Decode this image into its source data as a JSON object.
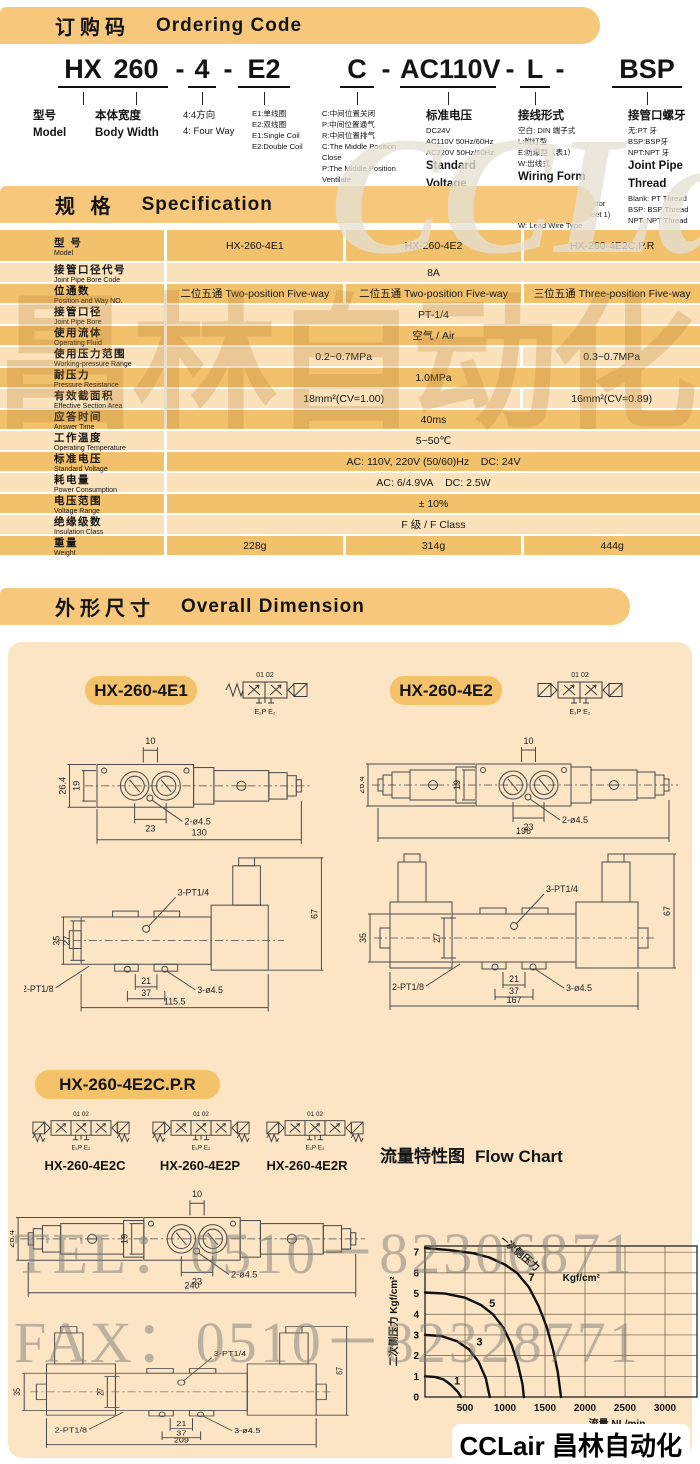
{
  "colors": {
    "banner": "#f7c87c",
    "row_dark": "#f2c16c",
    "row_light": "#fbe2bb",
    "panel": "#fbe5c4",
    "pill": "#f4c369",
    "ink": "#141414"
  },
  "ordering": {
    "banner_zh": "订购码",
    "banner_en": "Ordering Code",
    "code_parts": [
      "HX",
      "260",
      "-",
      "4",
      "-",
      "E2",
      "C",
      "-",
      "AC110V",
      "-",
      "L",
      "-",
      "BSP"
    ],
    "columns": [
      {
        "lines": [
          {
            "t": "型号",
            "b": 1
          },
          {
            "t": "Model",
            "b": 1
          }
        ]
      },
      {
        "lines": [
          {
            "t": "本体宽度",
            "b": 1
          },
          {
            "t": "Body Width",
            "b": 1
          }
        ]
      },
      {
        "lines": [
          {
            "t": "4:4方向"
          },
          {
            "t": "4: Four Way"
          }
        ]
      },
      {
        "lines": [
          {
            "t": "E1:单线圈"
          },
          {
            "t": "E2:双线圈"
          },
          {
            "t": "E1:Single Coil"
          },
          {
            "t": "E2:Double Coil"
          }
        ]
      },
      {
        "lines": [
          {
            "t": "C:中间位置关闭"
          },
          {
            "t": "P:中间位置通气"
          },
          {
            "t": "R:中间位置排气"
          },
          {
            "t": "C:The Middle Position"
          },
          {
            "t": "Close"
          },
          {
            "t": "P:The Middle Position"
          },
          {
            "t": "Ventilate"
          },
          {
            "t": "R:The Middle Position"
          },
          {
            "t": "Exhaust"
          }
        ]
      },
      {
        "lines": [
          {
            "t": "标准电压",
            "b": 1
          },
          {
            "t": "DC24V"
          },
          {
            "t": "AC110V 50Hz/60Hz"
          },
          {
            "t": "AC220V 50Hz/60Hz"
          },
          {
            "t": "Standard",
            "b": 1
          },
          {
            "t": "Voltage",
            "b": 1
          },
          {
            "t": "DC24V"
          },
          {
            "t": "AC110V 50Hz/60Hz"
          },
          {
            "t": "AC220V 50Hz/60Hz"
          }
        ]
      },
      {
        "lines": [
          {
            "t": "接线形式",
            "b": 1
          },
          {
            "t": "空白: DIN 端子式"
          },
          {
            "t": "L:附灯型"
          },
          {
            "t": "E:防爆型（表1）"
          },
          {
            "t": "W:出线式"
          },
          {
            "t": "Wiring Form",
            "b": 1
          },
          {
            "t": "Blank:DIN Connector"
          },
          {
            "t": "L:With Lighting Connector"
          },
          {
            "t": "E:Blast-proof Type(sheet 1)"
          },
          {
            "t": "W: Lead Wire Type"
          }
        ]
      },
      {
        "lines": [
          {
            "t": "接管口螺牙",
            "b": 1
          },
          {
            "t": "无:PT 牙"
          },
          {
            "t": "BSP:BSP牙"
          },
          {
            "t": "NPT:NPT 牙"
          },
          {
            "t": "Joint Pipe",
            "b": 1
          },
          {
            "t": "Thread",
            "b": 1
          },
          {
            "t": "Blank: PT Thread"
          },
          {
            "t": "BSP: BSP Thread"
          },
          {
            "t": "NPT: NPT Thread"
          }
        ]
      }
    ]
  },
  "spec": {
    "banner_zh": "规 格",
    "banner_en": "Specification",
    "rows": [
      {
        "zh": "型 号",
        "en": "Model",
        "cells": [
          {
            "t": "HX-260-4E1",
            "s": 1
          },
          {
            "t": "HX-260-4E2",
            "s": 1
          },
          {
            "t": "HX-260-4E2C.P.R",
            "s": 1
          }
        ]
      },
      {
        "zh": "接管口径代号",
        "en": "Joint Pipe Bore Code",
        "cells": [
          {
            "t": "8A",
            "s": 3
          }
        ]
      },
      {
        "zh": "位通数",
        "en": "Position and Way NO.",
        "cells": [
          {
            "t": "二位五通  Two-position Five-way",
            "s": 1
          },
          {
            "t": "二位五通  Two-position Five-way",
            "s": 1
          },
          {
            "t": "三位五通  Three-position Five-way",
            "s": 1
          }
        ]
      },
      {
        "zh": "接管口径",
        "en": "Joint Pipe Bore",
        "cells": [
          {
            "t": "PT-1/4",
            "s": 3
          }
        ]
      },
      {
        "zh": "使用流体",
        "en": "Operating Fluid",
        "cells": [
          {
            "t": "空气  /  Air",
            "s": 3
          }
        ]
      },
      {
        "zh": "使用压力范围",
        "en": "Working-pressure Range",
        "cells": [
          {
            "t": "0.2~0.7MPa",
            "s": 2
          },
          {
            "t": "0.3~0.7MPa",
            "s": 1
          }
        ]
      },
      {
        "zh": "耐压力",
        "en": "Pressure Resistance",
        "cells": [
          {
            "t": "1.0MPa",
            "s": 3
          }
        ]
      },
      {
        "zh": "有效截面积",
        "en": "Effective  Section  Area",
        "cells": [
          {
            "t": "18mm²(CV=1.00)",
            "s": 2
          },
          {
            "t": "16mm²(CV=0.89)",
            "s": 1
          }
        ]
      },
      {
        "zh": "应答时间",
        "en": "Answer Time",
        "cells": [
          {
            "t": "40ms",
            "s": 3
          }
        ]
      },
      {
        "zh": "工作温度",
        "en": "Operating Temperature",
        "cells": [
          {
            "t": "5~50℃",
            "s": 3
          }
        ]
      },
      {
        "zh": "标准电压",
        "en": "Standard Voltage",
        "cells": [
          {
            "t": "AC: 110V, 220V (50/60)Hz    DC: 24V",
            "s": 3
          }
        ]
      },
      {
        "zh": "耗电量",
        "en": "Power Consumption",
        "cells": [
          {
            "t": "AC: 6/4.9VA    DC: 2.5W",
            "s": 3
          }
        ]
      },
      {
        "zh": "电压范围",
        "en": "Voltage Range",
        "cells": [
          {
            "t": "± 10%",
            "s": 3
          }
        ]
      },
      {
        "zh": "绝缘级数",
        "en": "Insulation Class",
        "cells": [
          {
            "t": "F 级  /  F Class",
            "s": 3
          }
        ]
      },
      {
        "zh": "重量",
        "en": "Weight",
        "cells": [
          {
            "t": "228g",
            "s": 1
          },
          {
            "t": "314g",
            "s": 1
          },
          {
            "t": "444g",
            "s": 1
          }
        ]
      }
    ]
  },
  "dimension_section": {
    "banner_zh": "外形尺寸",
    "banner_en": "Overall Dimension",
    "pills": [
      "HX-260-4E1",
      "HX-260-4E2",
      "HX-260-4E2C.P.R"
    ],
    "sub_models": [
      "HX-260-4E2C",
      "HX-260-4E2P",
      "HX-260-4E2R"
    ]
  },
  "symbols": {
    "top": "01 02",
    "bottom": "E₁P E₂"
  },
  "dims": {
    "e1_top": {
      "s10": "10",
      "s264": "26.4",
      "s19": "19",
      "s23": "23",
      "holes": "2-ø4.5",
      "total": "130"
    },
    "e2_top": {
      "s10": "10",
      "s264": "26.4",
      "s19": "19",
      "s23": "23",
      "holes": "2-ø4.5",
      "total": "196"
    },
    "cpr_top": {
      "s10": "10",
      "s264": "26.4",
      "s19": "19",
      "s23": "23",
      "holes": "2-ø4.5",
      "total": "240"
    },
    "e1_side": {
      "pt": "3-PT1/4",
      "s35": "35",
      "s27": "27",
      "s67": "67",
      "pt2": "2-PT1/8",
      "s21": "21",
      "s37": "37",
      "holes": "3-ø4.5",
      "total": "115.5"
    },
    "e2_side": {
      "pt": "3-PT1/4",
      "s35": "35",
      "s27": "27",
      "s67": "67",
      "pt2": "2-PT1/8",
      "s21": "21",
      "s37": "37",
      "holes": "3-ø4.5",
      "total": "167"
    },
    "cpr_side": {
      "pt": "3-PT1/4",
      "s35": "35",
      "s27": "27",
      "s67": "67",
      "pt2": "2-PT1/8",
      "s21": "21",
      "s37": "37",
      "holes": "3-ø4.5",
      "total": "209"
    }
  },
  "chart_data": {
    "type": "line",
    "title_zh": "流量特性图",
    "title_en": "Flow Chart",
    "xlabel": "流量   NL/min",
    "ylabel": "二次侧压力   Kgf/cm²",
    "annotation": "一次侧压力",
    "annotation_unit": "Kgf/cm²",
    "xlim": [
      0,
      3400
    ],
    "ylim": [
      0,
      7.3
    ],
    "xticks": [
      500,
      1000,
      1500,
      2000,
      2500,
      3000
    ],
    "yticks": [
      0,
      1,
      2,
      3,
      4,
      5,
      6,
      7
    ],
    "grid": true,
    "legend": "inline curve labels",
    "series": [
      {
        "name": "7",
        "label_at": [
          1330,
          5.6
        ],
        "points": [
          [
            0,
            7.2
          ],
          [
            300,
            7.1
          ],
          [
            600,
            6.95
          ],
          [
            800,
            6.75
          ],
          [
            1000,
            6.4
          ],
          [
            1150,
            6.0
          ],
          [
            1300,
            5.3
          ],
          [
            1420,
            4.4
          ],
          [
            1520,
            3.4
          ],
          [
            1600,
            2.3
          ],
          [
            1660,
            1.2
          ],
          [
            1700,
            0
          ]
        ]
      },
      {
        "name": "5",
        "label_at": [
          840,
          4.35
        ],
        "points": [
          [
            0,
            5.05
          ],
          [
            250,
            5.0
          ],
          [
            500,
            4.8
          ],
          [
            700,
            4.45
          ],
          [
            850,
            4.0
          ],
          [
            980,
            3.35
          ],
          [
            1080,
            2.55
          ],
          [
            1160,
            1.6
          ],
          [
            1220,
            0.6
          ],
          [
            1235,
            0
          ]
        ]
      },
      {
        "name": "3",
        "label_at": [
          680,
          2.5
        ],
        "points": [
          [
            0,
            3.0
          ],
          [
            200,
            2.95
          ],
          [
            400,
            2.7
          ],
          [
            550,
            2.3
          ],
          [
            670,
            1.7
          ],
          [
            760,
            0.9
          ],
          [
            810,
            0
          ]
        ]
      },
      {
        "name": "1",
        "label_at": [
          400,
          0.6
        ],
        "points": [
          [
            0,
            1.0
          ],
          [
            120,
            0.97
          ],
          [
            230,
            0.85
          ],
          [
            320,
            0.6
          ],
          [
            410,
            0.25
          ],
          [
            450,
            0
          ]
        ]
      }
    ]
  },
  "watermarks": {
    "brand": "CCLair",
    "brand_zh": "昌林自动化",
    "tel": "TEL：0510－82306871",
    "fax": "FAX：0510－82328771",
    "footer": "CCLair 昌林自动化"
  }
}
